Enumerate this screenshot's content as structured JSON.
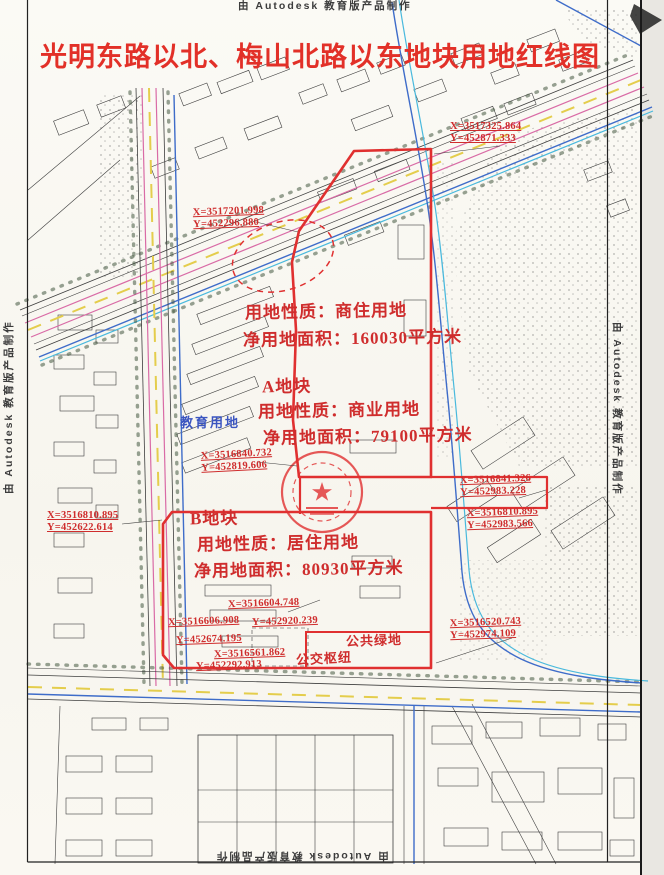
{
  "page": {
    "title": "光明东路以北、梅山北路以东地块用地红线图",
    "attribution": "由 Autodesk 教育版产品制作"
  },
  "annotations": {
    "site": {
      "use": "用地性质：商住用地",
      "area": "净用地面积：160030平方米"
    },
    "parcel_a": {
      "name": "A地块",
      "use": "用地性质：商业用地",
      "area": "净用地面积：79100平方米"
    },
    "parcel_b": {
      "name": "B地块",
      "use": "用地性质：居住用地",
      "area": "净用地面积：80930平方米"
    },
    "green_space": "公共绿地",
    "transit_hub": "公交枢纽",
    "education_land": "教育用地"
  },
  "coordinates": {
    "top_right": {
      "x": "X=3517325.864",
      "y": "Y=452871.333"
    },
    "upper_left": {
      "x": "X=3517201.998",
      "y": "Y=452296.880"
    },
    "mid_left": {
      "x": "X=3516840.732",
      "y": "Y=452819.606"
    },
    "west_edge": {
      "x": "X=3516810.895",
      "y": "Y=452622.614"
    },
    "east_step_1": {
      "x": "X=3516841.326",
      "y": "Y=452983.228"
    },
    "east_step_2": {
      "x": "X=3516810.895",
      "y": "Y=452983.566"
    },
    "south_right": {
      "x": "X=3516520.743",
      "y": "Y=452974.109"
    },
    "south_cluster": [
      "X=3516604.748",
      "X=3516606.908",
      "Y=452920.239",
      "Y=452674.195",
      "X=3516561.862",
      "Y=452292.913"
    ]
  },
  "colors": {
    "title_red": "#e23028",
    "red_line": "#e03030",
    "red_text": "#cf2d2d",
    "black_line": "#3e3e3e",
    "road_yellow": "#e4cd4c",
    "road_pink": "#d96ba6",
    "blue_line": "#3e6cc9",
    "cyan_line": "#49b9dd",
    "green_dots": "#44583f",
    "blue_text": "#3b55c0",
    "paper": "#fbfaf5"
  }
}
